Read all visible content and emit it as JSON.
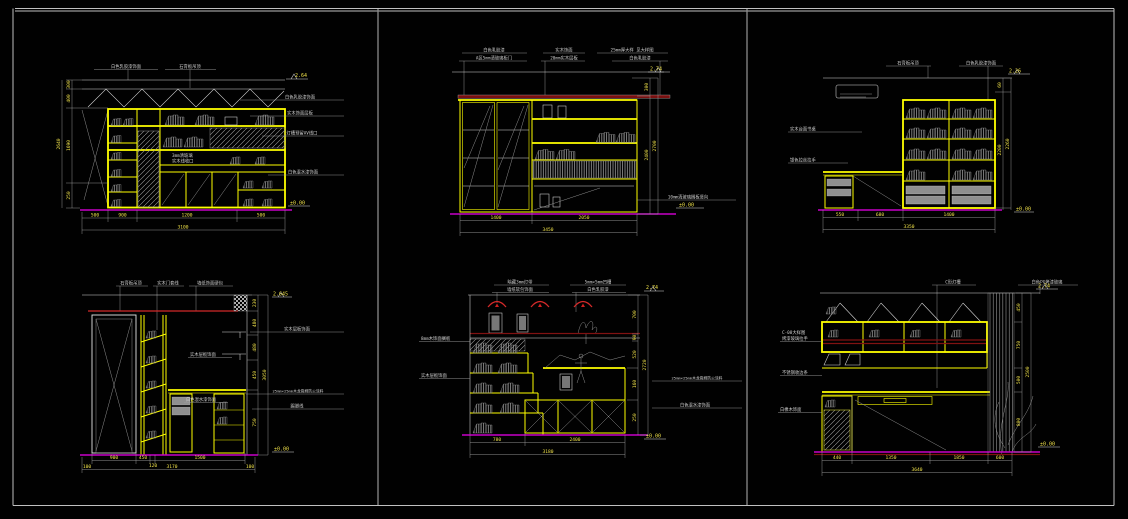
{
  "colors": {
    "background": "#000000",
    "frame": "#c0c0c0",
    "object_lines": "#d9d9d9",
    "cabinet_yellow": "#ffff00",
    "floor_magenta": "#c800c8",
    "accent_red": "#d42a2a",
    "dark_red_band": "#801212",
    "hatch_gray": "#9a9a9a",
    "dim_text_yellow": "#f0e24a",
    "label_text": "#cfcfcf"
  },
  "panel1": {
    "top_labels": [
      "白色乳胶漆饰面",
      "石膏板吊顶"
    ],
    "right_labels": [
      "白色乳胶漆饰面",
      "实木饰面层板",
      "灯槽预留AV线口",
      "白色混水漆饰面"
    ],
    "inner_labels": [
      "3mm清玻璃",
      "实木线收口"
    ],
    "elev_top": "2.64",
    "elev_bottom": "±0.00",
    "dims_left": [
      "300",
      "400",
      "1690",
      "250"
    ],
    "total_left": "2640",
    "dims_bottom": [
      "500",
      "900",
      "1200",
      "500"
    ],
    "total_bottom": "3100"
  },
  "panel2": {
    "top_groups": [
      [
        "白色乳胶漆",
        "A区5mm清玻璃柜门"
      ],
      [
        "实木饰面",
        "20mm实木层板"
      ],
      [
        "25mm厚大样 见大样图",
        "白色乳胶漆"
      ]
    ],
    "note_bottom": "10mm清玻璃搁板竖向",
    "elev_top": "2.74",
    "elev_bottom": "±0.00",
    "dims_right": [
      "300",
      "2400"
    ],
    "total_right": "2700",
    "dims_bottom": [
      "1400",
      "2050"
    ],
    "total_bottom": "3450"
  },
  "panel3": {
    "top_labels": [
      "石膏板吊顶",
      "白色乳胶漆饰面"
    ],
    "left_labels": [
      "实木台面书桌",
      "银色拉丝拉手"
    ],
    "elev_top": "2.26",
    "elev_bottom": "±0.00",
    "dims_right": [
      "60",
      "2200"
    ],
    "total_right": "2260",
    "dims_bottom": [
      "550",
      "680",
      "1400"
    ],
    "total_bottom": "3350"
  },
  "panel4": {
    "top_labels": [
      "石膏板吊顶",
      "实木门套线",
      "墙纸饰面硬包"
    ],
    "right_labels": [
      "实木层板饰面",
      "25mm×25mm木龙骨刷防火涂料",
      "踢脚线"
    ],
    "inner_labels": [
      "实木层板饰面",
      "白色混水漆饰面"
    ],
    "elev_top": "2.645",
    "elev_bottom": "±0.00",
    "dims_right": [
      "230",
      "480",
      "480",
      "450",
      "750"
    ],
    "total_right": "3050",
    "dims_bottom": [
      "900",
      "450",
      "120",
      "1500"
    ],
    "edge_dims": [
      "100",
      "100"
    ],
    "total_bottom": "3170"
  },
  "panel5": {
    "top_groups": [
      [
        "暗藏3mm灯带",
        "墙纸软包饰面"
      ],
      [
        "5mm×5mm凹槽",
        "白色乳胶漆"
      ]
    ],
    "left_labels": [
      "8mm木饰面搁板",
      "实木层板饰面"
    ],
    "right_labels": [
      "25mm×25mm木龙骨刷防火涂料",
      "白色混水漆饰面"
    ],
    "elev_top": "2.74",
    "elev_bottom": "±0.00",
    "dims_right": [
      "700",
      "90",
      "520",
      "160",
      "250"
    ],
    "total_right": "2720",
    "dims_bottom": [
      "780",
      "2400"
    ],
    "total_bottom": "3180"
  },
  "panel6": {
    "top_labels": [
      "C形灯槽",
      "白色PG烤漆玻璃"
    ],
    "left_group": [
      "C-08大样图",
      "烤漆玻璃拉手"
    ],
    "left_labels": [
      "不锈钢收边条",
      "白橡木饰面"
    ],
    "elev_top": "2.74",
    "elev_bottom": "±0.00",
    "dims_right": [
      "450",
      "750",
      "500",
      "800"
    ],
    "total_right": "2500",
    "dims_bottom": [
      "440",
      "1350",
      "1850",
      "600"
    ],
    "total_bottom": "3640"
  }
}
